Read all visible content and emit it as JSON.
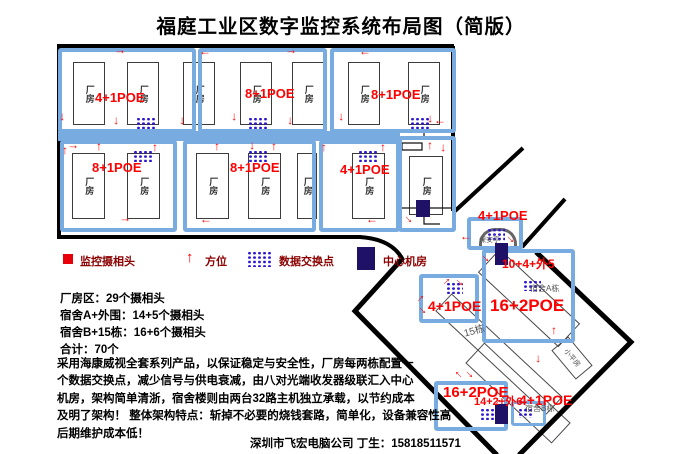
{
  "title": "福庭工业区数字监控系统布局图（简版）",
  "icons": {
    "direction_arrow": "↑"
  },
  "colors": {
    "box_blue": "#78abe0",
    "switch_blue": "#2b16cf",
    "navy": "#1e1166",
    "red": "#ff0000",
    "legend_text": "#8b0000"
  },
  "legend": {
    "camera_label": "监控摄相头",
    "direction_label": "方位",
    "switch_label": "数据交换点",
    "center_room_label": "中心机房"
  },
  "factory": {
    "building_label": "厂房",
    "row1": [
      {
        "poe": "4+1POE"
      },
      {
        "poe": "8+1POE"
      },
      {
        "poe": "8+1POE"
      }
    ],
    "row2": [
      {
        "poe": "8+1POE"
      },
      {
        "poe": "8+1POE"
      },
      {
        "poe": "4+1POE"
      }
    ]
  },
  "dorm": {
    "booth_poe": "4+1POE",
    "booth_name": "保安亭",
    "a_counts": "10+4+外5",
    "a_poe": "16+2POE",
    "a_name": "宿舍A栋",
    "b15_poe": "4+1POE",
    "b15_name": "15栋",
    "bungalow_name": "小平房",
    "b_poe": "16+2POE",
    "b_counts": "14+2+外6",
    "b_right_poe": "4+1POE",
    "b_name": "宿舍B栋"
  },
  "stats": {
    "line1": "厂房区：29个摄相头",
    "line2": "宿舍A+外围：14+5个摄相头",
    "line3": "宿舍B+15栋：16+6个摄相头",
    "line4": "合计：70个"
  },
  "description": "采用海康威视全套系列产品，以保证稳定与安全性，厂房每两栋配置一\n个数据交换点，减少信号与供电衰减，由八对光端收发器级联汇入中心\n机房，架构简单清浙，宿舍楼则由两台32路主机独立承载，以节约成本\n及明了架构！ 整体架构特点：斩掉不必要的烧钱套路，简单化，设备兼容性高\n后期维护成本低！",
  "footer": "深圳市飞宏电脑公司 丁生：15818511571"
}
